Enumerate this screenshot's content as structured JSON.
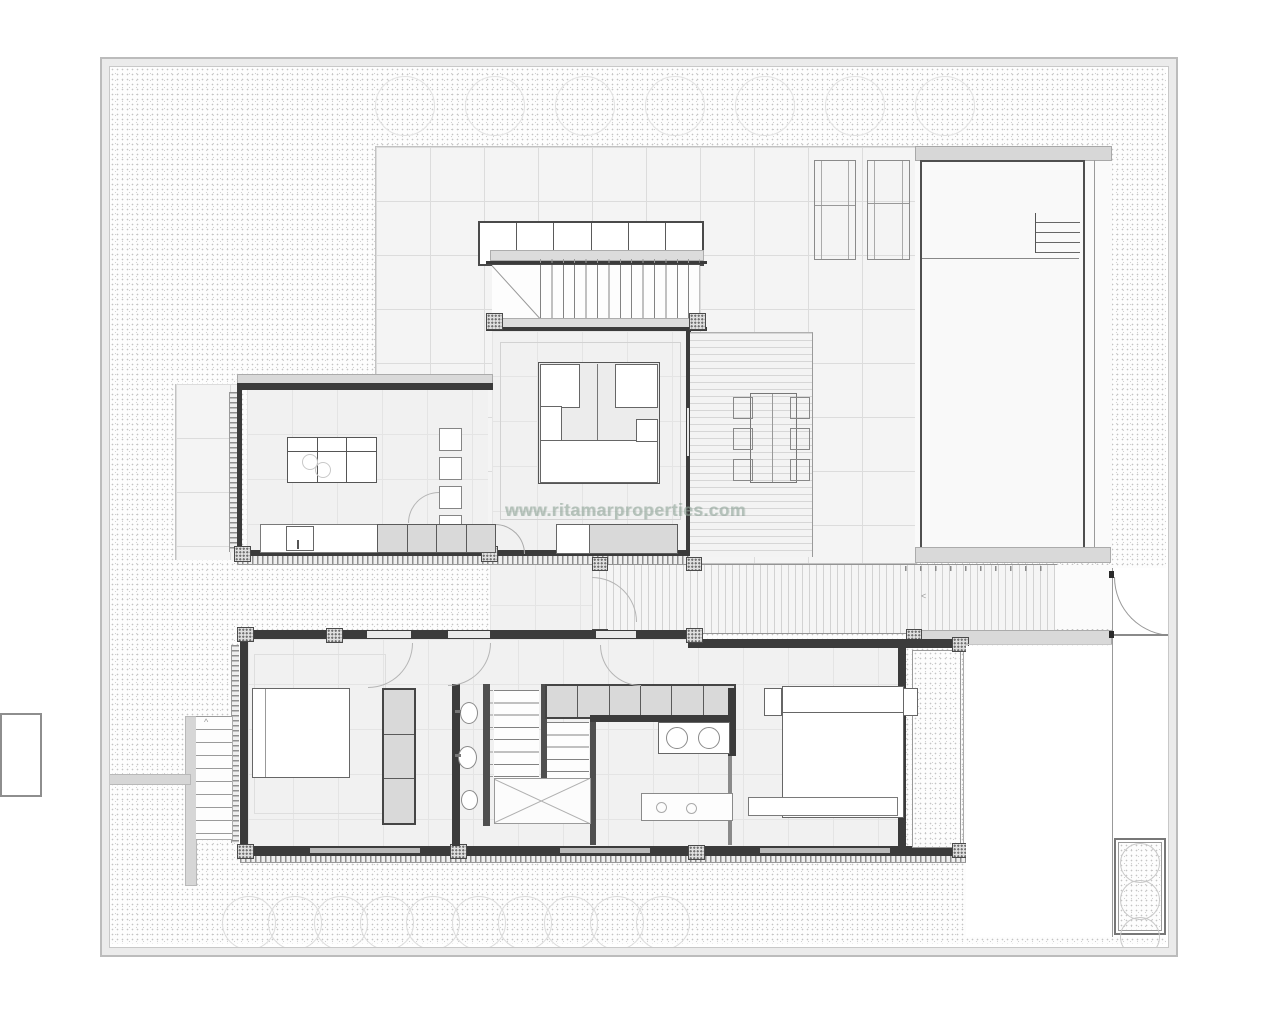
{
  "watermark": {
    "text": "www.ritamarproperties.com"
  },
  "glyphs": {
    "walkway_chevron": "<",
    "stair_chevron": "^"
  },
  "colors": {
    "wall": "#3b3b3b",
    "partition": "#4f4f4f",
    "furniture_gray": "#d9d9d9",
    "plot_band": "#ebebeb",
    "watermark": "#8fa498"
  },
  "counts": {
    "tree_circles": 7,
    "shrubs": 10,
    "planter_plants": 3,
    "storage_cells": 6,
    "wardrobe_cells": 6,
    "closet_shelves": 3,
    "kitchen_counter_gray_cells": 4,
    "kitchen_chairs": 4,
    "deck_chairs_per_side": 3
  }
}
